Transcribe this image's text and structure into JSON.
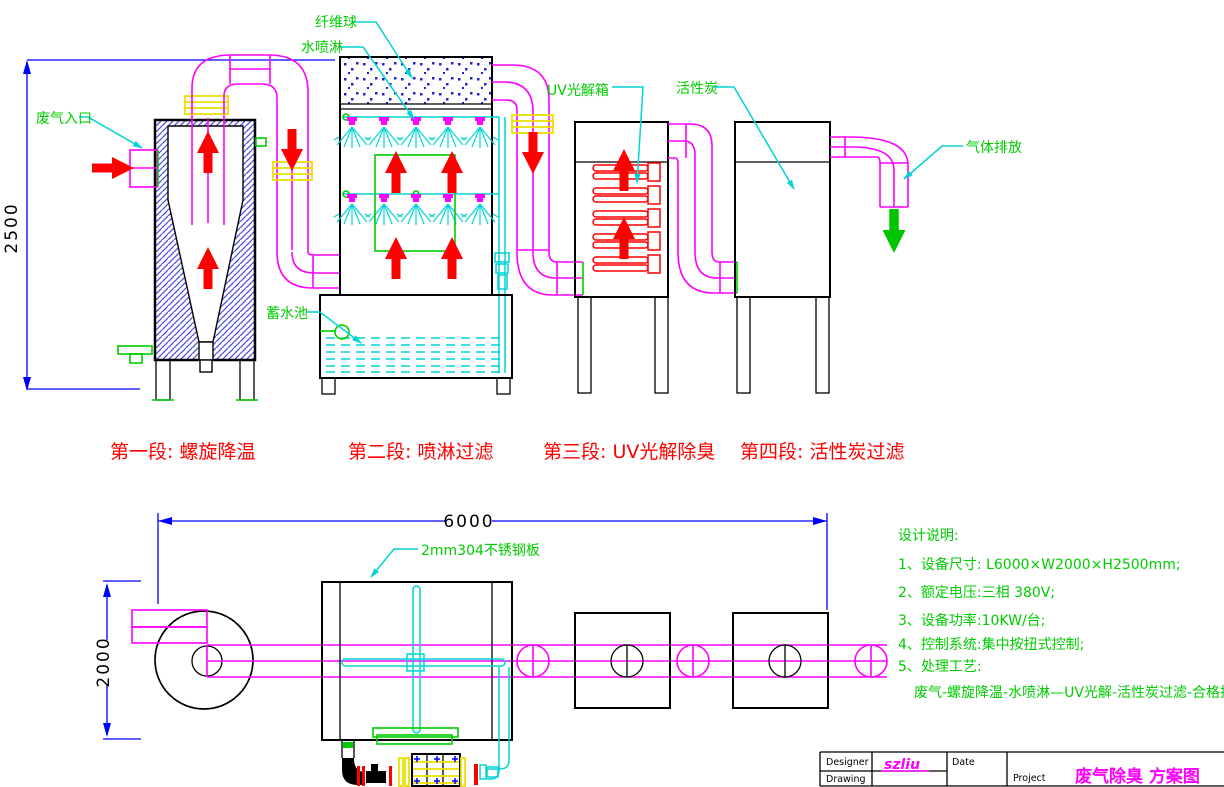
{
  "colors": {
    "magenta": "#ff00ff",
    "cyan": "#00d4d4",
    "green": "#00cc00",
    "red": "#ff0000",
    "blue": "#0000ff",
    "yellow": "#ece000",
    "black": "#000000",
    "hatch_blue": "#5050e0",
    "fiber_dot_blue": "#2222cc"
  },
  "side_view": {
    "dim_height": "2500",
    "labels": {
      "waste_gas_inlet": "废气入口",
      "fiber_ball": "纤维球",
      "water_spray": "水喷淋",
      "uv_photolysis_box": "UV光解箱",
      "activated_carbon": "活性炭",
      "gas_discharge": "气体排放",
      "water_pool": "蓄水池"
    }
  },
  "stage_captions": {
    "stage1": "第一段: 螺旋降温",
    "stage2": "第二段: 喷淋过滤",
    "stage3": "第三段: UV光解除臭",
    "stage4": "第四段: 活性炭过滤"
  },
  "plan_view": {
    "dim_length": "6000",
    "dim_width": "2000",
    "plate_label": "2mm304不锈钢板"
  },
  "design_notes": {
    "heading": "设计说明:",
    "item1": "1、设备尺寸: L6000×W2000×H2500mm;",
    "item2": "2、额定电压:三相 380V;",
    "item3": "3、设备功率:10KW/台;",
    "item4": "4、控制系统:集中按扭式控制;",
    "item5": "5、处理工艺:",
    "process_flow": "废气-螺旋降温-水喷淋—UV光解-活性炭过滤-合格排放"
  },
  "title_block": {
    "designer_label": "Designer",
    "drawing_label": "Drawing",
    "designer_value": "szliu",
    "date_label": "Date",
    "project_label": "Project",
    "project_title": "废气除臭 方案图"
  }
}
